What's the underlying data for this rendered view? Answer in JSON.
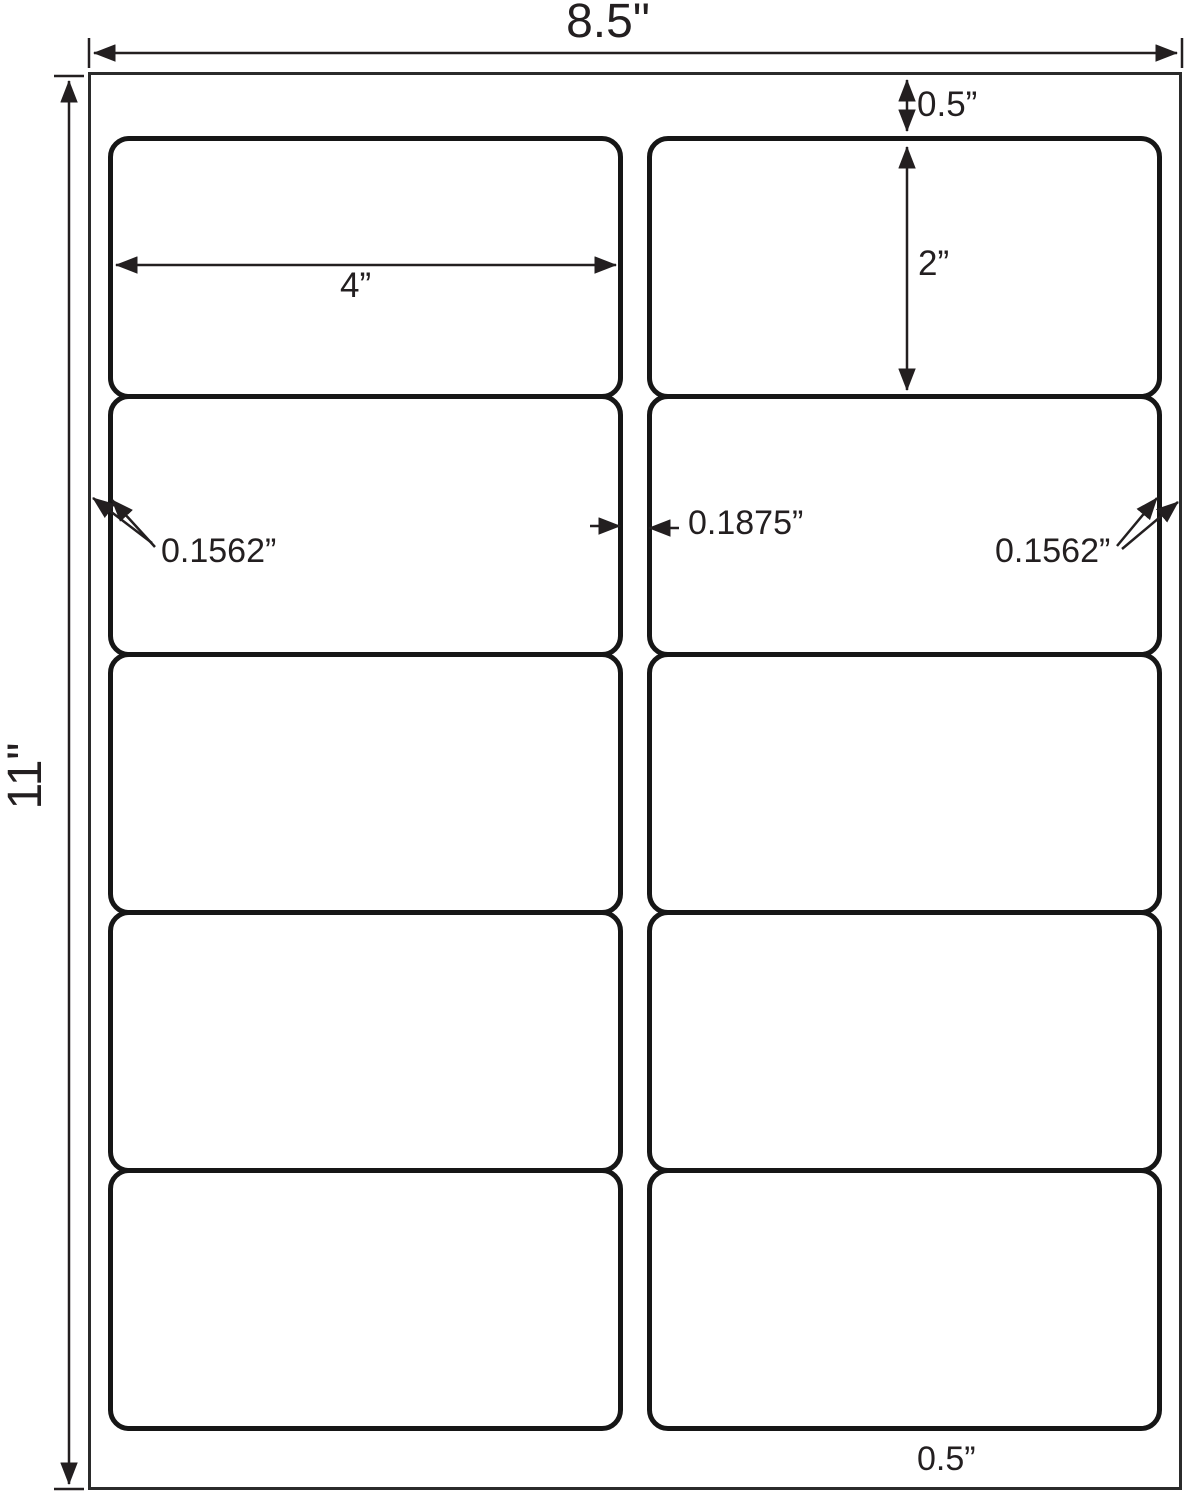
{
  "diagram": {
    "description": "Label sheet template dimension diagram: 10 rounded-corner labels in 2 columns by 5 rows on a letter-size sheet",
    "dimensions": {
      "sheet_width": "8.5\"",
      "sheet_height": "11\"",
      "top_margin": "0.5”",
      "label_height": "2”",
      "label_width": "4”",
      "left_margin": "0.1562”",
      "column_gap": "0.1875”",
      "right_margin": "0.1562”",
      "bottom_margin": "0.5”"
    },
    "grid": {
      "rows": 5,
      "columns": 2,
      "label_count": 10
    },
    "colors": {
      "line": "#231f20",
      "label_border": "#161616",
      "sheet_border": "#2b2b2b",
      "background": "#ffffff"
    }
  }
}
